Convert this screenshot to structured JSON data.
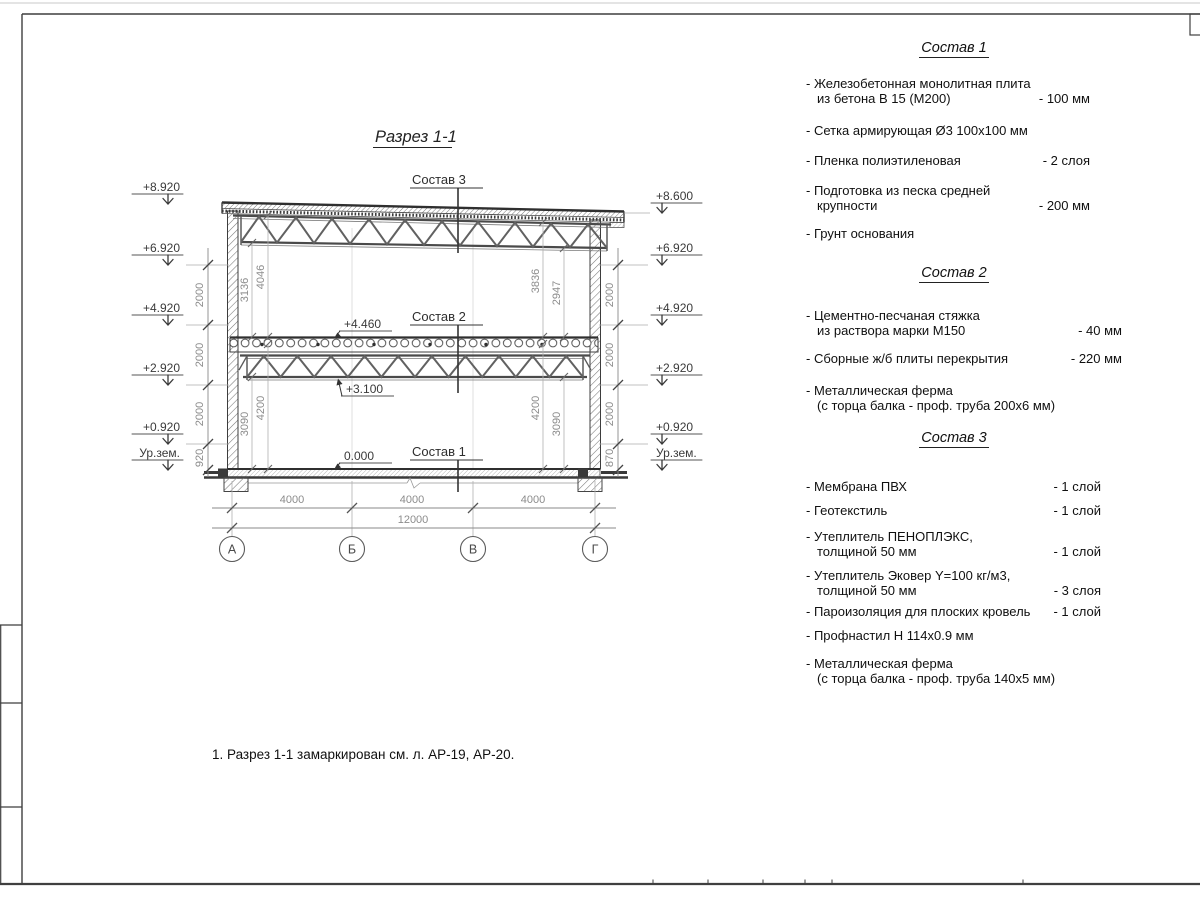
{
  "drawing": {
    "title": "Разрез 1-1",
    "labels": {
      "s1": "Состав 1",
      "s2": "Состав 2",
      "s3": "Состав 3"
    },
    "levels": {
      "l44": "+4.460",
      "l31": "+3.100",
      "l0": "0.000"
    },
    "left_marks": [
      "+8.920",
      "+6.920",
      "+4.920",
      "+2.920",
      "+0.920",
      "Ур.зем."
    ],
    "right_marks": [
      "+8.600",
      "+6.920",
      "+4.920",
      "+2.920",
      "+0.920",
      "Ур.зем."
    ],
    "left_chain": [
      "2000",
      "2000",
      "2000",
      "920"
    ],
    "right_chain": [
      "2000",
      "2000",
      "2000",
      "870"
    ],
    "dims_upper_left": [
      "3136",
      "4046"
    ],
    "dims_upper_right": [
      "3836",
      "2947"
    ],
    "dims_lower_left": [
      "3090",
      "4200"
    ],
    "dims_lower_right": [
      "4200",
      "3090"
    ],
    "dims_bottom": [
      "4000",
      "4000",
      "4000"
    ],
    "dim_total": "12000",
    "axes": [
      "А",
      "Б",
      "В",
      "Г"
    ]
  },
  "panel": {
    "sections": [
      {
        "title": "Состав 1",
        "items": [
          {
            "l1": "- Железобетонная монолитная плита",
            "l2": "из бетона В 15 (М200)",
            "value": "- 100 мм"
          },
          {
            "l1": "- Сетка армирующая Ø3 100х100 мм",
            "value": ""
          },
          {
            "l1": "- Пленка полиэтиленовая",
            "value": "- 2 слоя"
          },
          {
            "l1": "- Подготовка из песка средней",
            "l2": "крупности",
            "value": "- 200 мм"
          },
          {
            "l1": "- Грунт основания",
            "value": ""
          }
        ]
      },
      {
        "title": "Состав 2",
        "items": [
          {
            "l1": "- Цементно-песчаная стяжка",
            "l2": "из раствора марки М150",
            "value": "- 40 мм"
          },
          {
            "l1": "- Сборные ж/б плиты перекрытия",
            "value": "- 220 мм"
          },
          {
            "l1": "- Металлическая ферма",
            "l2": "(с торца балка - проф. труба 200х6 мм)",
            "value": ""
          }
        ]
      },
      {
        "title": "Состав 3",
        "items": [
          {
            "l1": "- Мембрана ПВХ",
            "value": "- 1 слой"
          },
          {
            "l1": "- Геотекстиль",
            "value": "- 1 слой"
          },
          {
            "l1": "- Утеплитель ПЕНОПЛЭКС,",
            "l2": "толщиной 50 мм",
            "value": "- 1 слой"
          },
          {
            "l1": "- Утеплитель Эковер Y=100 кг/м3,",
            "l2": "толщиной 50 мм",
            "value": "- 3 слоя"
          },
          {
            "l1": "- Пароизоляция для плоских кровель",
            "value": "- 1 слой"
          },
          {
            "l1": "- Профнастил Н 114х0.9 мм",
            "value": ""
          },
          {
            "l1": "- Металлическая ферма",
            "l2": "(с торца балка - проф. труба 140х5 мм)",
            "value": ""
          }
        ]
      }
    ]
  },
  "note": "1. Разрез 1-1 замаркирован см. л. АР-19, АР-20."
}
